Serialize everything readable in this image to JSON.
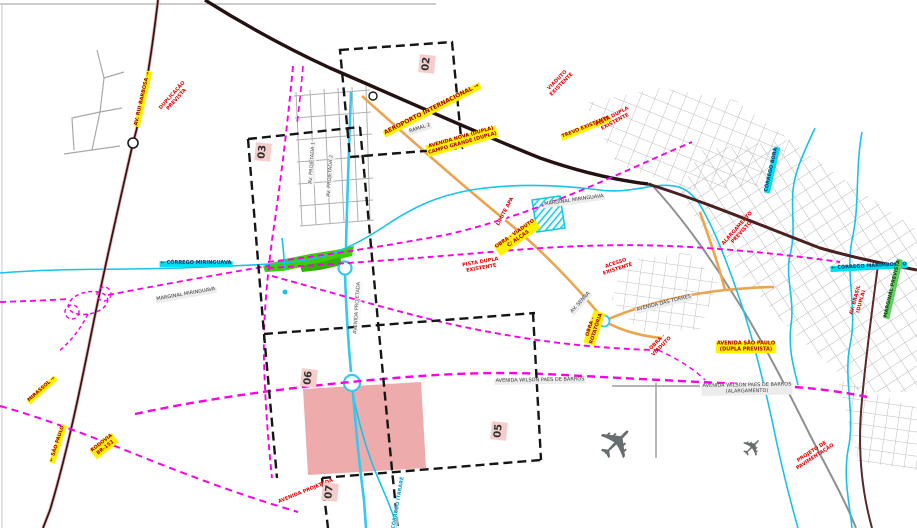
{
  "map": {
    "description": "Plano viário municipal - recorte com malha urbana, eixos projetados e folhas de articulação",
    "colors": {
      "planned_road_magenta": "#fa00e6",
      "stream_cyan": "#17c3e8",
      "planned_avenue_cyan": "#35c8f0",
      "existing_highway_dark": "#241111",
      "secondary_highway_brown": "#4a2020",
      "paved_avenue_orange": "#eca44f",
      "urban_grid_gray": "#b3b3b3",
      "green_area": "#3ecc0a",
      "study_zone_pink": "#ec9f9f",
      "sheet_index_dash": "#151515",
      "highlight_label_yellow": "#fff200"
    },
    "sheets": [
      {
        "n": "02",
        "x": 427,
        "y": 64
      },
      {
        "n": "03",
        "x": 263,
        "y": 152
      },
      {
        "n": "06",
        "x": 309,
        "y": 378
      },
      {
        "n": "05",
        "x": 499,
        "y": 431
      },
      {
        "n": "07",
        "x": 330,
        "y": 492
      }
    ],
    "labels": [
      {
        "t": "AV. RUI BARBOSA →",
        "x": 143,
        "y": 99,
        "r": -77,
        "s": "yellow"
      },
      {
        "t": "DUPLICAÇÃO\nPREVISTA",
        "x": 175,
        "y": 98,
        "r": -48,
        "s": "red"
      },
      {
        "t": "AEROPORTO INTERNACIONAL →",
        "x": 432,
        "y": 110,
        "r": -27,
        "s": "yellow",
        "fs": 6
      },
      {
        "t": "AVENIDA NOVA (DUPLA)\nCAMPO GRANDE (DUPLA)",
        "x": 462,
        "y": 141,
        "r": -16,
        "s": "yellow"
      },
      {
        "t": "RAMAL 2",
        "x": 420,
        "y": 129,
        "r": -18,
        "s": "gray"
      },
      {
        "t": "TREVO EXISTENTE",
        "x": 586,
        "y": 128,
        "r": -22,
        "s": "yellow"
      },
      {
        "t": "VIADUTO\nEXISTENTE",
        "x": 560,
        "y": 83,
        "r": -45,
        "s": "red"
      },
      {
        "t": "PISTA DUPLA\nEXISTENTE",
        "x": 614,
        "y": 120,
        "r": -28,
        "s": "red"
      },
      {
        "t": "LIMITE APA",
        "x": 506,
        "y": 212,
        "r": -62,
        "s": "whitered"
      },
      {
        "t": "MARGINAL MIRINGUAVA",
        "x": 574,
        "y": 201,
        "r": -8,
        "s": "gray"
      },
      {
        "t": "OBRA - VIADUTO\nC/ ALÇAS",
        "x": 517,
        "y": 237,
        "r": -35,
        "s": "yellow"
      },
      {
        "t": "← CÓRREGO MIRINGUAVA",
        "x": 196,
        "y": 264,
        "r": 0,
        "s": "cyan"
      },
      {
        "t": "MARGINAL MIRINGUAVA",
        "x": 186,
        "y": 295,
        "r": -10,
        "s": "gray"
      },
      {
        "t": "PISTA DUPLA\nEXISTENTE",
        "x": 481,
        "y": 266,
        "r": -10,
        "s": "red"
      },
      {
        "t": "ACESSO\nEXISTENTE",
        "x": 617,
        "y": 267,
        "r": -18,
        "s": "red"
      },
      {
        "t": "AV. SENNA",
        "x": 581,
        "y": 303,
        "r": -48,
        "s": "gray"
      },
      {
        "t": "OBRA -\nROTATÓRIA",
        "x": 594,
        "y": 328,
        "r": -72,
        "s": "yellow"
      },
      {
        "t": "AVENIDA DAS TORRES",
        "x": 664,
        "y": 304,
        "r": -14,
        "s": "gray"
      },
      {
        "t": "ALARGAMENTO\nPREVISTO",
        "x": 740,
        "y": 231,
        "r": -48,
        "s": "red"
      },
      {
        "t": "AVENIDA SÃO PAULO\n(DUPLA PREVISTA)",
        "x": 746,
        "y": 347,
        "r": 0,
        "s": "yellow"
      },
      {
        "t": "OBRA -\nVIADUTO",
        "x": 660,
        "y": 345,
        "r": -45,
        "s": "red"
      },
      {
        "t": "CÓRREGO BORÁ",
        "x": 772,
        "y": 170,
        "r": -77,
        "s": "cyan"
      },
      {
        "t": "← CÓRREGO MARIMBONDO",
        "x": 869,
        "y": 267,
        "r": -3,
        "s": "cyan"
      },
      {
        "t": "AV. BRASIL\n(DUPLA)",
        "x": 859,
        "y": 301,
        "r": -75,
        "s": "red"
      },
      {
        "t": "MARGINAL PREVISTA",
        "x": 893,
        "y": 289,
        "r": -77,
        "s": "green"
      },
      {
        "t": "AVENIDA WILSON PAES DE BARROS",
        "x": 540,
        "y": 381,
        "r": -1,
        "s": "gray"
      },
      {
        "t": "AVENIDA WILSON PAES DE BARROS\n(ALARGAMENTO)",
        "x": 747,
        "y": 389,
        "r": -1,
        "s": "gray"
      },
      {
        "t": "MIRASSOL →",
        "x": 42,
        "y": 390,
        "r": -42,
        "s": "yellow"
      },
      {
        "t": "← SÃO PAULO",
        "x": 58,
        "y": 444,
        "r": -72,
        "s": "yellow"
      },
      {
        "t": "RODOVIA\nBR-153",
        "x": 104,
        "y": 446,
        "r": -38,
        "s": "yellow"
      },
      {
        "t": "AVENIDA PROJETADA",
        "x": 358,
        "y": 308,
        "r": -86,
        "s": "dark"
      },
      {
        "t": "AV. PROJETADA 1",
        "x": 313,
        "y": 163,
        "r": -86,
        "s": "dark"
      },
      {
        "t": "AV. PROJETADA 2",
        "x": 331,
        "y": 176,
        "r": -86,
        "s": "dark"
      },
      {
        "t": "CÓRREGO ITARARÉ",
        "x": 399,
        "y": 503,
        "r": -80,
        "s": "darkcyan"
      },
      {
        "t": "AVENIDA PROJETADA",
        "x": 306,
        "y": 492,
        "r": -22,
        "s": "red"
      },
      {
        "t": "PROJETO DE\nPAVIMENTAÇÃO",
        "x": 814,
        "y": 455,
        "r": -33,
        "s": "red"
      }
    ],
    "icons": [
      {
        "name": "airplane-icon",
        "glyph": "✈",
        "x": 617,
        "y": 443,
        "size": 46
      },
      {
        "name": "airplane-icon",
        "glyph": "✈",
        "x": 753,
        "y": 448,
        "size": 26
      }
    ]
  }
}
